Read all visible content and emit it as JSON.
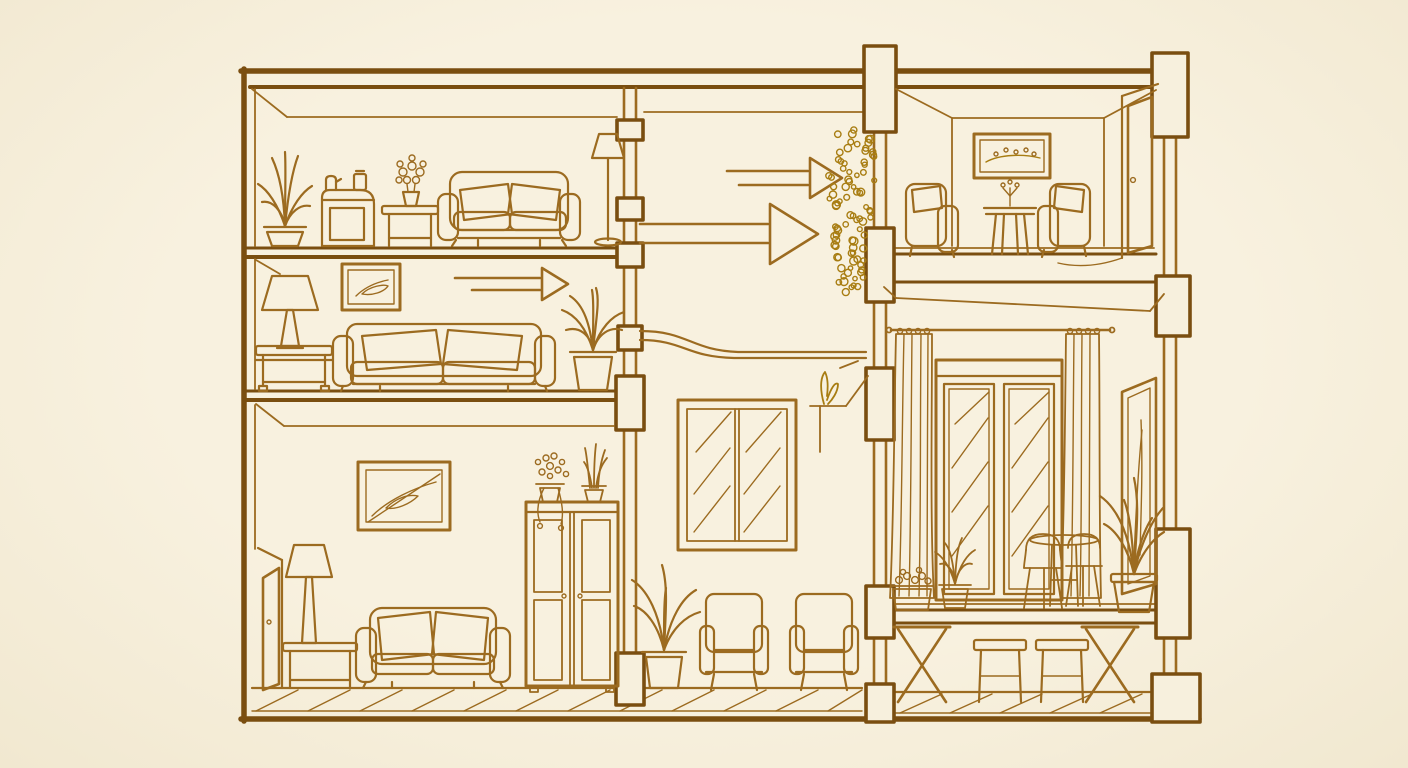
{
  "illustration": {
    "title": "Cutaway house cross-section line drawing",
    "style": "single-color ink sketch on cream paper",
    "palette": {
      "paper": "#f7f0dd",
      "ink": "#9c6b20",
      "ink_dark": "#7a4e10",
      "plant_ink": "#a87d12"
    },
    "airflow_arrow_count": 3,
    "rooms": [
      {
        "name": "top-left-living-room",
        "furniture": [
          "potted-plant",
          "cabinet-with-kettle-and-jar",
          "side-table-with-flower-pot",
          "two-seat-sofa",
          "floor-lamp"
        ]
      },
      {
        "name": "middle-left-lounge",
        "furniture": [
          "table-lamp-on-side-table",
          "framed-picture",
          "three-seat-sofa",
          "potted-plant"
        ],
        "annotations": [
          "right-pointing-arrow"
        ]
      },
      {
        "name": "bottom-left-bedroom",
        "furniture": [
          "open-door",
          "table-lamp-on-side-table",
          "framed-picture",
          "loveseat-sofa",
          "double-door-wardrobe",
          "trailing-plant-on-wardrobe",
          "snake-plant-on-wardrobe"
        ],
        "floor": "diagonal-plank"
      },
      {
        "name": "center-hall",
        "furniture": [
          "hanging-plant",
          "wall-mirror",
          "corner-ledge-plant",
          "floor-plant",
          "armchair",
          "armchair"
        ],
        "annotations": [
          "small-right-arrow",
          "large-right-arrow",
          "curved-duct-line"
        ]
      },
      {
        "name": "top-right-sitting-room",
        "furniture": [
          "framed-picture",
          "facing-armchair-left",
          "facing-armchair-right",
          "side-table-with-sprig",
          "interior-door"
        ]
      },
      {
        "name": "bottom-right-terrace-room",
        "furniture": [
          "curtain-rod",
          "left-curtain",
          "right-curtain",
          "glazed-window",
          "window-box-flowers",
          "small-spiky-plant",
          "bistro-chair",
          "bistro-table",
          "large-potted-plant",
          "leaning-mirror"
        ],
        "substructure": [
          "x-trestle",
          "stool",
          "stool",
          "x-trestle"
        ],
        "floor": "raised-deck-over-plank-ground"
      }
    ]
  }
}
